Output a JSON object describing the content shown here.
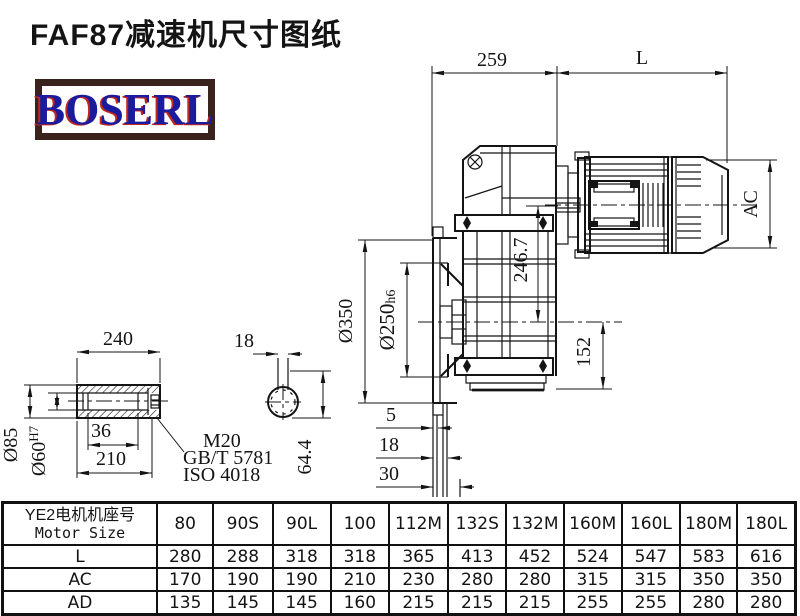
{
  "title": "FAF87减速机尺寸图纸",
  "logo": {
    "text": "BOSERL"
  },
  "colors": {
    "line": "#141414",
    "logo_border": "#3a231c",
    "logo_text": "#1b1b9e",
    "logo_shadow": "#c3271c",
    "background": "#ffffff"
  },
  "drawing": {
    "dims": {
      "gearbox_length": "259",
      "motor_length": "L",
      "motor_diameter": "AC",
      "flange_od": "Ø350",
      "spigot": "Ø250",
      "spigot_tol": "h6",
      "axis_distance": "246.7",
      "base_height": "152",
      "plate_step1": "5",
      "plate_step2": "18",
      "plate_step3": "30"
    },
    "shaft_view": {
      "shaft_length": "240",
      "key_length": "36",
      "bore_depth": "210",
      "shaft_od": "Ø85",
      "bore": "Ø60",
      "bore_tol": "H7",
      "screw": "M20",
      "standard_gb": "GB/T 5781",
      "standard_iso": "ISO 4018",
      "key_width": "18",
      "key_depth": "64.4"
    }
  },
  "table": {
    "header_cn": "YE2电机机座号",
    "header_en": "Motor Size",
    "columns": [
      "80",
      "90S",
      "90L",
      "100",
      "112M",
      "132S",
      "132M",
      "160M",
      "160L",
      "180M",
      "180L"
    ],
    "rows": [
      {
        "label": "L",
        "values": [
          "280",
          "288",
          "318",
          "318",
          "365",
          "413",
          "452",
          "524",
          "547",
          "583",
          "616"
        ]
      },
      {
        "label": "AC",
        "values": [
          "170",
          "190",
          "190",
          "210",
          "230",
          "280",
          "280",
          "315",
          "315",
          "350",
          "350"
        ]
      },
      {
        "label": "AD",
        "values": [
          "135",
          "145",
          "145",
          "160",
          "215",
          "215",
          "215",
          "255",
          "255",
          "280",
          "280"
        ]
      }
    ]
  }
}
